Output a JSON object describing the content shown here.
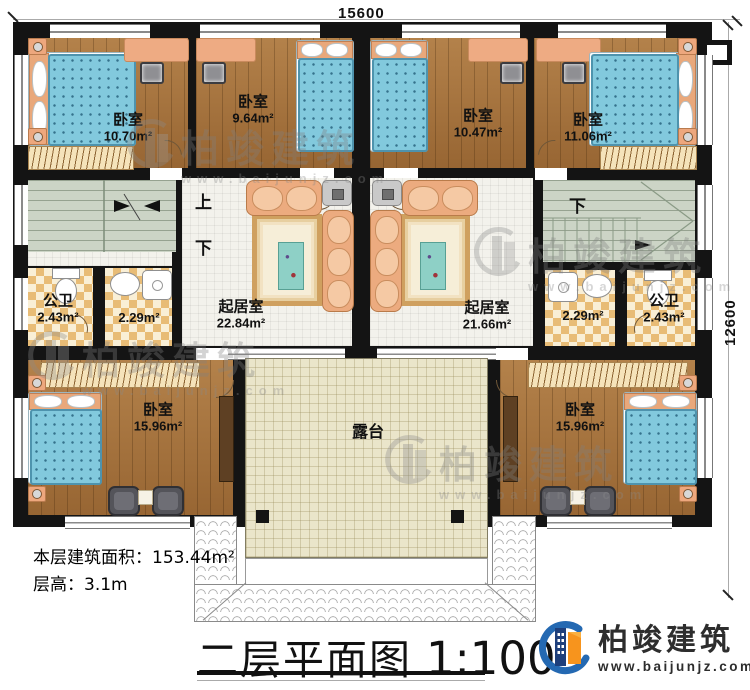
{
  "dimensions": {
    "width_label": "15600",
    "height_label": "12600"
  },
  "stairs": {
    "up": "上",
    "down_left": "下",
    "down_right": "下"
  },
  "rooms": {
    "bedroom_top_left": {
      "name": "卧室",
      "area": "10.70m²"
    },
    "bedroom_top_mid_left": {
      "name": "卧室",
      "area": "9.64m²"
    },
    "bedroom_top_mid_right": {
      "name": "卧室",
      "area": "10.47m²"
    },
    "bedroom_top_right": {
      "name": "卧室",
      "area": "11.06m²"
    },
    "bathroom_left": {
      "name": "公卫",
      "area": "2.43m²"
    },
    "washroom_left": {
      "area": "2.29m²"
    },
    "living_left": {
      "name": "起居室",
      "area": "22.84m²"
    },
    "living_right": {
      "name": "起居室",
      "area": "21.66m²"
    },
    "washroom_right": {
      "area": "2.29m²"
    },
    "bathroom_right": {
      "name": "公卫",
      "area": "2.43m²"
    },
    "bedroom_bottom_left": {
      "name": "卧室",
      "area": "15.96m²"
    },
    "bedroom_bottom_right": {
      "name": "卧室",
      "area": "15.96m²"
    },
    "terrace": {
      "name": "露台"
    }
  },
  "info": {
    "area_line": "本层建筑面积：153.44m²",
    "height_line": "层高：3.1m"
  },
  "title": {
    "name": "二层平面图",
    "scale": "1:100"
  },
  "brand": {
    "name": "柏竣建筑",
    "url": "www.baijunjz.com"
  },
  "watermark": {
    "name": "柏竣建筑",
    "url": "www.baijunjz.com"
  },
  "colors": {
    "wall": "#141414",
    "wood": "#a5713c",
    "mattress": "#82c9dd",
    "accent_blue": "#2469b2",
    "accent_orange": "#f7941d"
  }
}
